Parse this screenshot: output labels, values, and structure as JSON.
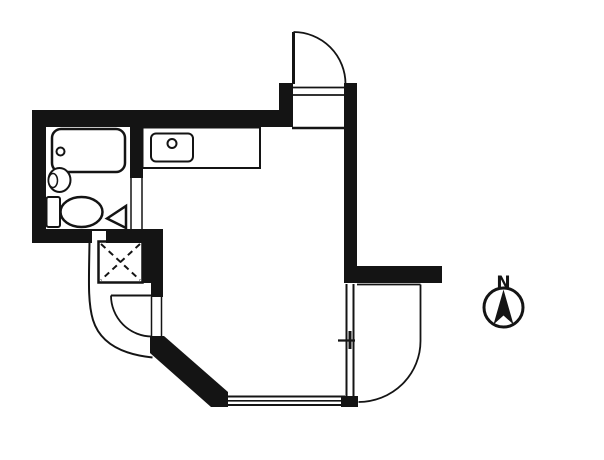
{
  "compass": {
    "north_label": "N"
  },
  "colors": {
    "line": "#141414",
    "background": "#ffffff"
  },
  "elements": {
    "entrance_door": "entrance-door-swing",
    "entry_threshold": "entry-threshold-lines",
    "entry_step": "entry-step-line",
    "bathroom": "unit-bathroom",
    "bathtub": "bathtub",
    "bathtub_drain": "bathtub-drain",
    "washbasin": "washbasin",
    "toilet": "toilet",
    "bathroom_door": "bathroom-door-triangle",
    "kitchen_counter": "kitchen-counter",
    "kitchen_sink": "kitchen-sink",
    "kitchen_faucet": "kitchen-faucet",
    "pipe_shaft": "pipe-shaft-x-box",
    "shaft_door": "balcony-door-swing",
    "balcony_left_edge": "curved-balcony-left",
    "balcony_right_edge": "curved-balcony-right",
    "south_window": "south-window-triple-line",
    "east_window": "east-sliding-window",
    "compass": "compass-north"
  }
}
